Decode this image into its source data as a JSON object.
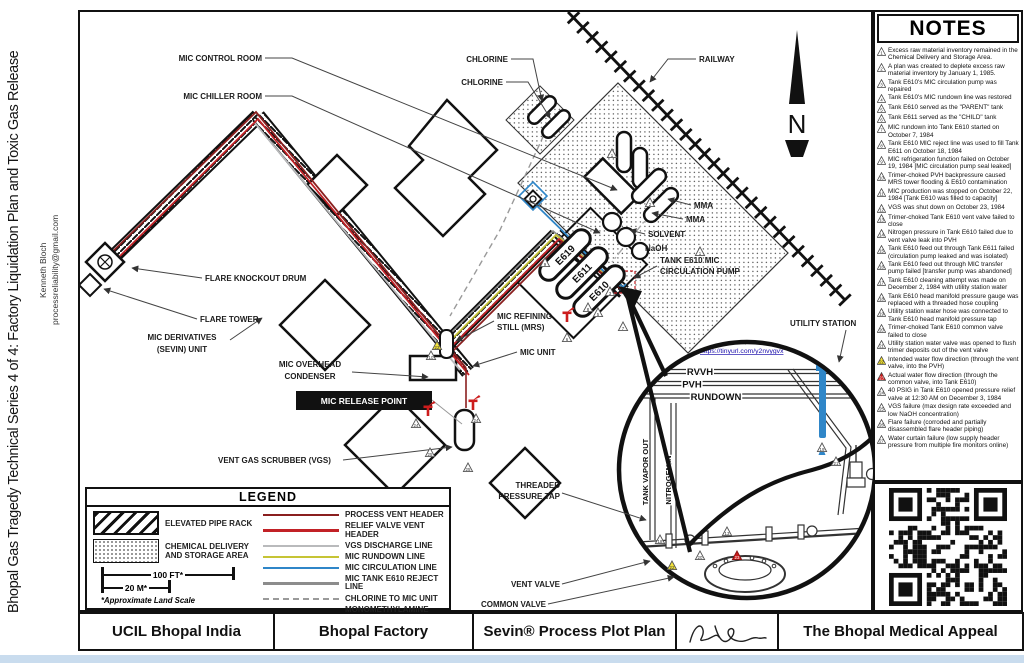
{
  "sidebar": {
    "title": "Bhopal Gas Tragedy Technical Series 4 of 4: Factory Liquidation Plan and Toxic Gas Release",
    "author": "Kenneth Bloch",
    "email": "processreliability@gmail.com"
  },
  "notes": {
    "title": "NOTES",
    "items": [
      {
        "n": "1",
        "text": "Excess raw material inventory remained in the Chemical Delivery and Storage Area."
      },
      {
        "n": "2",
        "text": "A plan was created to deplete excess raw material inventory by January 1, 1985."
      },
      {
        "n": "3",
        "text": "Tank E610's MIC circulation pump was repaired"
      },
      {
        "n": "4",
        "text": "Tank E610's MIC rundown line was restored"
      },
      {
        "n": "5",
        "text": "Tank E610 served as the \"PARENT\" tank"
      },
      {
        "n": "6",
        "text": "Tank E611 served as the \"CHILD\" tank"
      },
      {
        "n": "7",
        "text": "MIC rundown into Tank E610 started on October 7, 1984"
      },
      {
        "n": "8",
        "text": "Tank E610 MIC reject line was used to fill Tank E611 on October 18, 1984"
      },
      {
        "n": "9",
        "text": "MIC refrigeration function failed on October 19, 1984 [MIC circulation pump seal leaked]"
      },
      {
        "n": "10",
        "text": "Trimer-choked PVH backpressure caused MRS tower flooding & E610 contamination"
      },
      {
        "n": "11",
        "text": "MIC production was stopped on October 22, 1984 [Tank E610 was filled to capacity]"
      },
      {
        "n": "12",
        "text": "VGS was shut down on October 23, 1984"
      },
      {
        "n": "13",
        "text": "Trimer-choked Tank E610 vent valve failed to close"
      },
      {
        "n": "14",
        "text": "Nitrogen pressure in Tank E610 failed due to vent valve leak into PVH"
      },
      {
        "n": "15",
        "text": "Tank E610 feed out through Tank E611 failed (circulation pump leaked and was isolated)"
      },
      {
        "n": "16",
        "text": "Tank E610 feed out through MIC transfer pump failed [transfer pump was abandoned]"
      },
      {
        "n": "17",
        "text": "Tank E610 cleaning attempt was made on December 2, 1984 with utility station water"
      },
      {
        "n": "18",
        "text": "Tank E610 head manifold pressure gauge was replaced with a threaded hose coupling"
      },
      {
        "n": "19",
        "text": "Utility station water hose was connected to Tank E610 head manifold pressure tap"
      },
      {
        "n": "20",
        "text": "Trimer-choked Tank E610 common valve failed to close"
      },
      {
        "n": "21",
        "text": "Utility station water valve was opened to flush trimer deposits out of the vent valve"
      },
      {
        "n": "22",
        "c": "yellow",
        "text": "Intended water flow direction (through the vent valve, into the PVH)"
      },
      {
        "n": "23",
        "c": "red",
        "text": "Actual water flow direction (through the common valve, into Tank E610)"
      },
      {
        "n": "24",
        "text": "40 PSIG in Tank E610 opened pressure relief valve at 12:30 AM on December 3, 1984"
      },
      {
        "n": "25",
        "text": "VGS failure (max design rate exceeded and low NaOH concentration)"
      },
      {
        "n": "26",
        "text": "Flare failure (corroded and partially disassembled flare header piping)"
      },
      {
        "n": "27",
        "text": "Water curtain failure (low supply header pressure from multiple fire monitors online)"
      }
    ]
  },
  "legend": {
    "title": "LEGEND",
    "areas": [
      {
        "label": "ELEVATED PIPE RACK",
        "swatch": "hatch"
      },
      {
        "label": "CHEMICAL DELIVERY AND STORAGE AREA",
        "swatch": "dots"
      }
    ],
    "scale": {
      "top": "100 FT*",
      "bottom": "20 M*",
      "note": "*Approximate Land Scale"
    },
    "lines": [
      {
        "label": "PROCESS VENT HEADER",
        "color": "#8a1f1f",
        "style": "solid"
      },
      {
        "label": "RELIEF VALVE VENT HEADER",
        "color": "#c22126",
        "style": "solid"
      },
      {
        "label": "VGS DISCHARGE LINE",
        "color": "#b9babc",
        "style": "solid"
      },
      {
        "label": "MIC RUNDOWN LINE",
        "color": "#c6c435",
        "style": "solid"
      },
      {
        "label": "MIC CIRCULATION LINE",
        "color": "#2f86c8",
        "style": "solid"
      },
      {
        "label": "MIC TANK E610 REJECT LINE",
        "color": "#8c8c8c",
        "style": "solid"
      },
      {
        "label": "CHLORINE TO MIC UNIT",
        "color": "#9a9a9a",
        "style": "dashed"
      },
      {
        "label": "MONOMETHYLAMINE (MMA) TO MIC UNIT",
        "color": "#a8a8a8",
        "style": "dashdot"
      }
    ]
  },
  "titlebar": {
    "cells": [
      "UCIL Bhopal India",
      "Bhopal Factory",
      "Sevin® Process Plot Plan",
      "The Bhopal Medical Appeal"
    ]
  },
  "diagram": {
    "compass": "N",
    "labels": {
      "mic_control_room": "MIC CONTROL ROOM",
      "mic_chiller_room": "MIC CHILLER ROOM",
      "chlorine1": "CHLORINE",
      "chlorine2": "CHLORINE",
      "railway": "RAILWAY",
      "mma1": "MMA",
      "mma2": "MMA",
      "solvent": "SOLVENT",
      "naoh": "NaOH",
      "tank_e610_l1": "TANK E610 MIC",
      "tank_e610_l2": "CIRCULATION PUMP",
      "utility_station": "UTILITY STATION",
      "flare_knockout_drum": "FLARE KNOCKOUT DRUM",
      "flare_tower": "FLARE TOWER",
      "mic_derivatives_l1": "MIC DERIVATIVES",
      "mic_derivatives_l2": "(SEVIN) UNIT",
      "mic_overhead_l1": "MIC OVERHEAD",
      "mic_overhead_l2": "CONDENSER",
      "mic_release_point": "MIC RELEASE POINT",
      "mic_refining_l1": "MIC REFINING",
      "mic_refining_l2": "STILL (MRS)",
      "mic_unit": "MIC UNIT",
      "vgs": "VENT GAS SCRUBBER (VGS)",
      "threaded_l1": "THREADED",
      "threaded_l2": "PRESSURE TAP",
      "vent_valve": "VENT VALVE",
      "common_valve": "COMMON VALVE"
    },
    "tanks": [
      "E619",
      "E611",
      "E610"
    ],
    "inset": {
      "credit_l1": "Inset tank manifold graphic from A. D. Little",
      "credit_report": "report:",
      "credit_url": "https://tinyurl.com/y2nvygvx",
      "rvvh": "RVVH",
      "pvh": "PVH",
      "rundown": "RUNDOWN",
      "tank_vapor_out": "TANK VAPOR OUT",
      "nitrogen_in": "NITROGEN IN"
    },
    "markers": [
      {
        "x": 612,
        "y": 154,
        "n": "1"
      },
      {
        "x": 650,
        "y": 203,
        "n": "2"
      },
      {
        "x": 700,
        "y": 252,
        "n": "1"
      },
      {
        "x": 545,
        "y": 263,
        "n": "9"
      },
      {
        "x": 598,
        "y": 313,
        "n": "5"
      },
      {
        "x": 567,
        "y": 338,
        "n": "6"
      },
      {
        "x": 623,
        "y": 327,
        "n": "7"
      },
      {
        "x": 610,
        "y": 292,
        "n": "3"
      },
      {
        "x": 588,
        "y": 308,
        "n": "8"
      },
      {
        "x": 431,
        "y": 356,
        "n": "10"
      },
      {
        "x": 476,
        "y": 419,
        "n": "24"
      },
      {
        "x": 430,
        "y": 453,
        "n": "25"
      },
      {
        "x": 468,
        "y": 468,
        "n": "25"
      },
      {
        "x": 416,
        "y": 424,
        "n": "24"
      },
      {
        "x": 700,
        "y": 556,
        "n": "20"
      },
      {
        "x": 727,
        "y": 532,
        "n": "13"
      },
      {
        "x": 822,
        "y": 448,
        "n": "19"
      },
      {
        "x": 836,
        "y": 462,
        "n": "21"
      },
      {
        "x": 660,
        "y": 540,
        "n": "18"
      },
      {
        "x": 437,
        "y": 346,
        "n": "22",
        "c": "yellow"
      },
      {
        "x": 672,
        "y": 566,
        "n": "22",
        "c": "yellow"
      },
      {
        "x": 737,
        "y": 556,
        "n": "23",
        "c": "red"
      }
    ],
    "monitors": [
      {
        "x": 428,
        "y": 408
      },
      {
        "x": 473,
        "y": 402
      },
      {
        "x": 567,
        "y": 314
      }
    ]
  },
  "colors": {
    "process_vent": "#8a1f1f",
    "relief_vent": "#c22126",
    "vgs_discharge": "#b9babc",
    "rundown": "#c6c435",
    "circulation": "#2f86c8",
    "reject": "#8c8c8c",
    "marker_yellow": "#f2e23a",
    "marker_red": "#cc1c1c",
    "link_blue": "#1a0dab"
  }
}
